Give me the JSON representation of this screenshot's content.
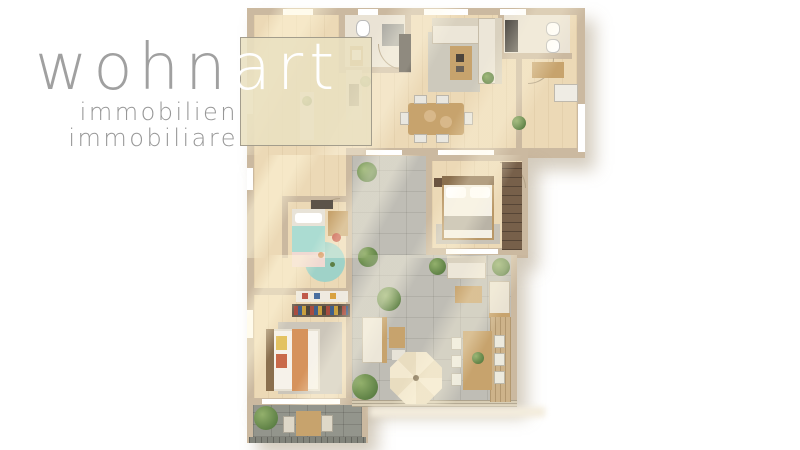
{
  "logo": {
    "brand_main": "wohn",
    "brand_accent": "art",
    "subtitle_de": "immobilien",
    "subtitle_it": "immobiliare"
  },
  "colors": {
    "wall": "#cbb9a0",
    "white": "#ffffff",
    "cream": "#ece6d8",
    "creamDark": "#d9d1bf",
    "woodF": "#c7a36d",
    "woodDark": "#8a6f4e",
    "darkUnit": "#54504a",
    "mint": "#abdcd2",
    "terracotta": "#d6935c",
    "grayRug": "#ccc6ba",
    "accentBeige": "#e9e0c0",
    "logoGray": "#a0a0a0"
  },
  "scene": [
    {
      "n": "footprint-top",
      "x": 247,
      "y": 8,
      "w": 338,
      "h": 150,
      "c": "wall",
      "cls": "shadow"
    },
    {
      "n": "footprint-mid",
      "x": 247,
      "y": 155,
      "w": 281,
      "h": 103,
      "c": "wall",
      "cls": "shadow"
    },
    {
      "n": "footprint-bottom",
      "x": 247,
      "y": 255,
      "w": 270,
      "h": 150,
      "c": "wall",
      "cls": "shadow"
    },
    {
      "n": "footprint-balcony",
      "x": 247,
      "y": 398,
      "w": 121,
      "h": 45,
      "c": "wall",
      "cls": "shadow"
    },
    {
      "n": "floor-living-dining",
      "x": 254,
      "y": 15,
      "w": 323,
      "h": 133,
      "cls": "wood"
    },
    {
      "n": "floor-hall-kids-room",
      "x": 254,
      "y": 148,
      "w": 92,
      "h": 146,
      "cls": "wood"
    },
    {
      "n": "floor-bedroom-2",
      "x": 254,
      "y": 294,
      "w": 92,
      "h": 105,
      "cls": "wood"
    },
    {
      "n": "floor-master-bedroom",
      "x": 432,
      "y": 161,
      "w": 90,
      "h": 89,
      "cls": "wood"
    },
    {
      "n": "terrace-upper",
      "x": 352,
      "y": 155,
      "w": 80,
      "h": 100,
      "cls": "tile"
    },
    {
      "n": "terrace-main",
      "x": 352,
      "y": 255,
      "w": 159,
      "h": 147,
      "cls": "tile"
    },
    {
      "n": "balcony-floor",
      "x": 253,
      "y": 404,
      "w": 109,
      "h": 33,
      "cls": "tiledark"
    },
    {
      "n": "bath1-floor",
      "x": 345,
      "y": 15,
      "w": 60,
      "h": 52,
      "cls": "lightfloor"
    },
    {
      "n": "bath2-floor",
      "x": 504,
      "y": 15,
      "w": 66,
      "h": 38,
      "cls": "lightfloor"
    },
    {
      "n": "wall-living-terrace-divider",
      "x": 346,
      "y": 148,
      "w": 182,
      "h": 8,
      "c": "wall"
    },
    {
      "n": "wall-kids-right",
      "x": 346,
      "y": 156,
      "w": 6,
      "h": 138,
      "c": "wall"
    },
    {
      "n": "wall-bedroom2-top",
      "x": 254,
      "y": 288,
      "w": 92,
      "h": 7,
      "c": "wall"
    },
    {
      "n": "wall-master-left",
      "x": 426,
      "y": 155,
      "w": 6,
      "h": 100,
      "c": "wall"
    },
    {
      "n": "wall-master-bottom",
      "x": 426,
      "y": 248,
      "w": 102,
      "h": 7,
      "c": "wall"
    },
    {
      "n": "wall-terrace-right",
      "x": 511,
      "y": 255,
      "w": 6,
      "h": 150,
      "c": "wall"
    },
    {
      "n": "wall-balcony-right",
      "x": 362,
      "y": 398,
      "w": 6,
      "h": 45,
      "c": "wall"
    },
    {
      "n": "wall-bedroom2-bottom",
      "x": 247,
      "y": 398,
      "w": 115,
      "h": 7,
      "c": "wall"
    },
    {
      "n": "wall-kids-top",
      "x": 282,
      "y": 196,
      "w": 70,
      "h": 6,
      "c": "wall"
    },
    {
      "n": "wall-kids-left",
      "x": 282,
      "y": 196,
      "w": 6,
      "h": 62,
      "c": "wall"
    },
    {
      "n": "wall-bath1-left",
      "x": 339,
      "y": 15,
      "w": 6,
      "h": 58,
      "c": "wall"
    },
    {
      "n": "wall-bath1-bottom",
      "x": 345,
      "y": 67,
      "w": 66,
      "h": 6,
      "c": "wall"
    },
    {
      "n": "wall-bath1-right",
      "x": 405,
      "y": 15,
      "w": 6,
      "h": 58,
      "c": "wall"
    },
    {
      "n": "wall-bath2-left",
      "x": 498,
      "y": 15,
      "w": 6,
      "h": 44,
      "c": "wall"
    },
    {
      "n": "wall-bath2-bottom",
      "x": 498,
      "y": 53,
      "w": 74,
      "h": 6,
      "c": "wall"
    },
    {
      "n": "wall-hall-divider",
      "x": 516,
      "y": 59,
      "w": 6,
      "h": 96,
      "c": "wall"
    },
    {
      "n": "window-top-1",
      "x": 283,
      "y": 9,
      "w": 30,
      "h": 6,
      "c": "white"
    },
    {
      "n": "window-top-2",
      "x": 358,
      "y": 9,
      "w": 20,
      "h": 6,
      "c": "white"
    },
    {
      "n": "window-top-3",
      "x": 424,
      "y": 9,
      "w": 44,
      "h": 6,
      "c": "white"
    },
    {
      "n": "window-top-4",
      "x": 500,
      "y": 9,
      "w": 26,
      "h": 6,
      "c": "white"
    },
    {
      "n": "window-left-1",
      "x": 247,
      "y": 88,
      "w": 6,
      "h": 26,
      "c": "white"
    },
    {
      "n": "window-left-2",
      "x": 247,
      "y": 168,
      "w": 6,
      "h": 22,
      "c": "white"
    },
    {
      "n": "window-left-3",
      "x": 247,
      "y": 310,
      "w": 6,
      "h": 28,
      "c": "white"
    },
    {
      "n": "window-right-1",
      "x": 578,
      "y": 104,
      "w": 7,
      "h": 48,
      "c": "white"
    },
    {
      "n": "window-slider-1",
      "x": 366,
      "y": 150,
      "w": 36,
      "h": 5,
      "c": "white"
    },
    {
      "n": "window-slider-2",
      "x": 438,
      "y": 150,
      "w": 56,
      "h": 5,
      "c": "white"
    },
    {
      "n": "window-master",
      "x": 446,
      "y": 249,
      "w": 52,
      "h": 5,
      "c": "white"
    },
    {
      "n": "window-bedroom2",
      "x": 262,
      "y": 399,
      "w": 78,
      "h": 5,
      "c": "white"
    },
    {
      "n": "terrace-railing",
      "x": 352,
      "y": 400,
      "w": 165,
      "h": 7,
      "cls": "rail"
    },
    {
      "n": "balcony-railing",
      "x": 249,
      "y": 437,
      "w": 117,
      "h": 6,
      "cls": "raildark"
    },
    {
      "n": "terrace-shadow-band",
      "x": 370,
      "y": 407,
      "w": 175,
      "h": 10,
      "c": "#f3ecdc",
      "cls": "soft"
    },
    {
      "n": "door-arc-bath1",
      "x": 378,
      "y": 44,
      "w": 26,
      "h": 26,
      "cls": "arc-bl"
    },
    {
      "n": "door-arc-hall",
      "x": 528,
      "y": 58,
      "w": 26,
      "h": 26,
      "cls": "arc-br"
    },
    {
      "n": "door-arc-master",
      "x": 500,
      "y": 162,
      "w": 26,
      "h": 26,
      "cls": "arc-tr"
    },
    {
      "n": "door-arc-kids",
      "x": 318,
      "y": 198,
      "w": 22,
      "h": 22,
      "cls": "arc-tl"
    },
    {
      "n": "living-rug",
      "x": 428,
      "y": 32,
      "w": 52,
      "h": 60,
      "c": "#cdc9bc"
    },
    {
      "n": "sofa-horizontal",
      "x": 432,
      "y": 18,
      "w": 70,
      "h": 26,
      "c": "cream",
      "b": "1px solid rgba(130,110,80,0.35)"
    },
    {
      "n": "sofa-back-top",
      "x": 432,
      "y": 18,
      "w": 70,
      "h": 8,
      "c": "creamDark"
    },
    {
      "n": "sofa-vertical",
      "x": 478,
      "y": 18,
      "w": 24,
      "h": 66,
      "c": "cream",
      "b": "1px solid rgba(130,110,80,0.35)"
    },
    {
      "n": "sofa-back-right",
      "x": 495,
      "y": 18,
      "w": 7,
      "h": 66,
      "c": "creamDark"
    },
    {
      "n": "coffee-table",
      "x": 450,
      "y": 46,
      "w": 22,
      "h": 34,
      "c": "woodF"
    },
    {
      "n": "coffee-table-decor-1",
      "x": 456,
      "y": 54,
      "w": 8,
      "h": 8,
      "c": "#4c443c"
    },
    {
      "n": "coffee-table-decor-2",
      "x": 456,
      "y": 66,
      "w": 8,
      "h": 6,
      "c": "#6b6258"
    },
    {
      "n": "dining-table",
      "x": 408,
      "y": 103,
      "w": 56,
      "h": 32,
      "c": "woodF",
      "r": "3px"
    },
    {
      "n": "dining-chair-1",
      "x": 414,
      "y": 95,
      "w": 13,
      "h": 9,
      "c": "#e9e7e0",
      "b": "1px solid rgba(120,110,90,0.4)"
    },
    {
      "n": "dining-chair-2",
      "x": 436,
      "y": 95,
      "w": 13,
      "h": 9,
      "c": "#e9e7e0",
      "b": "1px solid rgba(120,110,90,0.4)"
    },
    {
      "n": "dining-chair-3",
      "x": 414,
      "y": 134,
      "w": 13,
      "h": 9,
      "c": "#e9e7e0",
      "b": "1px solid rgba(120,110,90,0.4)"
    },
    {
      "n": "dining-chair-4",
      "x": 436,
      "y": 134,
      "w": 13,
      "h": 9,
      "c": "#e9e7e0",
      "b": "1px solid rgba(120,110,90,0.4)"
    },
    {
      "n": "dining-chair-5",
      "x": 400,
      "y": 112,
      "w": 9,
      "h": 13,
      "c": "#e9e7e0",
      "b": "1px solid rgba(120,110,90,0.4)"
    },
    {
      "n": "dining-chair-6",
      "x": 464,
      "y": 112,
      "w": 9,
      "h": 13,
      "c": "#e9e7e0",
      "b": "1px solid rgba(120,110,90,0.4)"
    },
    {
      "n": "dining-stool-1",
      "x": 424,
      "y": 110,
      "d": 12,
      "c": "#d8b88a"
    },
    {
      "n": "dining-stool-2",
      "x": 440,
      "y": 116,
      "d": 12,
      "c": "#d8b88a"
    },
    {
      "n": "kitchen-counter",
      "x": 346,
      "y": 70,
      "w": 16,
      "h": 50,
      "c": "#e9e1d1"
    },
    {
      "n": "kitchen-cooktop",
      "x": 349,
      "y": 84,
      "w": 10,
      "h": 22,
      "c": "#4a453f"
    },
    {
      "n": "kitchen-island",
      "x": 300,
      "y": 92,
      "w": 14,
      "h": 48,
      "c": "#f1eee7"
    },
    {
      "n": "island-plant",
      "x": 302,
      "y": 96,
      "d": 10,
      "cls": "plant"
    },
    {
      "n": "counter-plant",
      "x": 360,
      "y": 76,
      "d": 11,
      "cls": "plant"
    },
    {
      "n": "toilet-bath1",
      "x": 356,
      "y": 20,
      "w": 14,
      "h": 17,
      "c": "white",
      "r": "40%",
      "b": "1px solid #bbb"
    },
    {
      "n": "shower-tray",
      "x": 382,
      "y": 24,
      "w": 22,
      "h": 22,
      "c": "#a9a8a2"
    },
    {
      "n": "shower-glass-panel",
      "x": 399,
      "y": 34,
      "w": 12,
      "h": 38,
      "c": "#45403a"
    },
    {
      "n": "vanity-bath1",
      "x": 350,
      "y": 46,
      "w": 13,
      "h": 20,
      "c": "woodF"
    },
    {
      "n": "basin-bath1",
      "x": 352,
      "y": 50,
      "w": 9,
      "h": 10,
      "c": "white"
    },
    {
      "n": "washer-stack",
      "x": 505,
      "y": 20,
      "w": 13,
      "h": 32,
      "c": "darkUnit"
    },
    {
      "n": "toilet-bath2",
      "x": 546,
      "y": 22,
      "w": 14,
      "h": 14,
      "c": "white",
      "r": "40%",
      "b": "1px solid #bbb"
    },
    {
      "n": "bidet-bath2",
      "x": 546,
      "y": 39,
      "w": 14,
      "h": 14,
      "c": "white",
      "r": "40%",
      "b": "1px solid #bbb"
    },
    {
      "n": "hall-bench",
      "x": 532,
      "y": 62,
      "w": 32,
      "h": 16,
      "c": "woodF"
    },
    {
      "n": "hall-wardrobe",
      "x": 554,
      "y": 84,
      "w": 24,
      "h": 18,
      "c": "#efece4",
      "b": "1px solid rgba(120,110,90,0.4)"
    },
    {
      "n": "hall-plant",
      "x": 512,
      "y": 116,
      "d": 14,
      "cls": "plant"
    },
    {
      "n": "master-rug",
      "x": 436,
      "y": 224,
      "w": 64,
      "h": 20,
      "c": "#c9c3b7"
    },
    {
      "n": "master-bed-frame",
      "x": 442,
      "y": 176,
      "w": 52,
      "h": 64,
      "c": "#b99767"
    },
    {
      "n": "master-mattress",
      "x": 444,
      "y": 184,
      "w": 48,
      "h": 54,
      "c": "#f4f0e6"
    },
    {
      "n": "master-headboard",
      "x": 442,
      "y": 176,
      "w": 52,
      "h": 9,
      "c": "woodDark"
    },
    {
      "n": "master-pillow-1",
      "x": 446,
      "y": 187,
      "w": 20,
      "h": 11,
      "c": "white",
      "r": "3px"
    },
    {
      "n": "master-pillow-2",
      "x": 470,
      "y": 187,
      "w": 20,
      "h": 11,
      "c": "white",
      "r": "3px"
    },
    {
      "n": "master-throw",
      "x": 444,
      "y": 216,
      "w": 48,
      "h": 14,
      "c": "#b9b3a6"
    },
    {
      "n": "master-nightstand",
      "x": 434,
      "y": 178,
      "w": 8,
      "h": 9,
      "c": "#6b5440"
    },
    {
      "n": "master-wardrobe",
      "x": 502,
      "y": 162,
      "w": 20,
      "h": 88,
      "c": "#77604a",
      "cls": "shelves"
    },
    {
      "n": "kids-dresser",
      "x": 311,
      "y": 200,
      "w": 22,
      "h": 9,
      "c": "#5c5349"
    },
    {
      "n": "kids-rug",
      "x": 305,
      "y": 242,
      "d": 40,
      "c": "#9fd2c8"
    },
    {
      "n": "kids-bed-frame",
      "x": 292,
      "y": 209,
      "w": 33,
      "h": 58,
      "c": "#e8e3d8"
    },
    {
      "n": "kids-pillow",
      "x": 295,
      "y": 213,
      "w": 27,
      "h": 10,
      "c": "white",
      "r": "3px"
    },
    {
      "n": "kids-blanket-mint",
      "x": 292,
      "y": 226,
      "w": 33,
      "h": 26,
      "c": "mint"
    },
    {
      "n": "kids-blanket-pink",
      "x": 292,
      "y": 252,
      "w": 33,
      "h": 15,
      "c": "#f0d9d2"
    },
    {
      "n": "kids-desk",
      "x": 328,
      "y": 211,
      "w": 20,
      "h": 25,
      "c": "woodF"
    },
    {
      "n": "kids-chair",
      "x": 332,
      "y": 233,
      "d": 9,
      "c": "#c44f3e"
    },
    {
      "n": "kids-toy-1",
      "x": 318,
      "y": 252,
      "d": 6,
      "c": "terracotta"
    },
    {
      "n": "kids-toy-2",
      "x": 330,
      "y": 262,
      "d": 5,
      "c": "#5d7f46"
    },
    {
      "n": "bedroom2-art-shelf",
      "x": 296,
      "y": 291,
      "w": 52,
      "h": 11,
      "c": "#efeae0"
    },
    {
      "n": "art-item-1",
      "x": 302,
      "y": 293,
      "w": 6,
      "h": 6,
      "c": "#c05a4a"
    },
    {
      "n": "art-item-2",
      "x": 314,
      "y": 293,
      "w": 6,
      "h": 6,
      "c": "#4a6fa0"
    },
    {
      "n": "art-item-3",
      "x": 330,
      "y": 293,
      "w": 6,
      "h": 6,
      "c": "#d9a23f"
    },
    {
      "n": "bedroom2-bookshelf",
      "x": 292,
      "y": 304,
      "w": 58,
      "h": 13,
      "c": "#6b5e50"
    },
    {
      "n": "bookshelf-books",
      "x": 294,
      "y": 306,
      "w": 54,
      "h": 9,
      "cls": "books"
    },
    {
      "n": "bedroom2-rug",
      "x": 278,
      "y": 322,
      "w": 64,
      "h": 72,
      "c": "grayRug"
    },
    {
      "n": "bedroom2-bed-frame",
      "x": 266,
      "y": 329,
      "w": 54,
      "h": 62,
      "c": "#e6e0d2"
    },
    {
      "n": "bedroom2-headboard",
      "x": 266,
      "y": 329,
      "w": 8,
      "h": 62,
      "c": "woodDark"
    },
    {
      "n": "bedroom2-mattress",
      "x": 274,
      "y": 331,
      "w": 44,
      "h": 58,
      "c": "#f6f2ea"
    },
    {
      "n": "bedroom2-pillow-yellow",
      "x": 276,
      "y": 336,
      "w": 11,
      "h": 14,
      "c": "#e3c261"
    },
    {
      "n": "bedroom2-pillow-orange",
      "x": 276,
      "y": 354,
      "w": 11,
      "h": 14,
      "c": "#c96a4a"
    },
    {
      "n": "bedroom2-runner",
      "x": 292,
      "y": 329,
      "w": 16,
      "h": 62,
      "c": "terracotta"
    },
    {
      "n": "terrace-armchair",
      "x": 362,
      "y": 317,
      "w": 24,
      "h": 46,
      "c": "cream",
      "b": "1px solid rgba(130,110,80,0.35)"
    },
    {
      "n": "terrace-armchair-frame",
      "x": 382,
      "y": 317,
      "w": 5,
      "h": 46,
      "c": "woodF"
    },
    {
      "n": "terrace-side-table",
      "x": 389,
      "y": 327,
      "w": 16,
      "h": 21,
      "c": "woodF"
    },
    {
      "n": "terrace-side-chair",
      "x": 392,
      "y": 350,
      "w": 13,
      "h": 10,
      "c": "#e7e3d8"
    },
    {
      "n": "terrace-plant-1",
      "x": 377,
      "y": 287,
      "d": 24,
      "cls": "plant"
    },
    {
      "n": "terrace-plant-2",
      "x": 357,
      "y": 162,
      "d": 20,
      "cls": "plant"
    },
    {
      "n": "terrace-plant-3",
      "x": 358,
      "y": 247,
      "d": 20,
      "cls": "plant"
    },
    {
      "n": "outdoor-sofa",
      "x": 447,
      "y": 256,
      "w": 39,
      "h": 23,
      "c": "cream",
      "b": "1px solid rgba(130,110,80,0.35)"
    },
    {
      "n": "outdoor-sofa-back",
      "x": 447,
      "y": 256,
      "w": 39,
      "h": 7,
      "c": "creamDark"
    },
    {
      "n": "outdoor-sofa-plant",
      "x": 429,
      "y": 258,
      "d": 17,
      "cls": "plant"
    },
    {
      "n": "outdoor-coffee-table",
      "x": 455,
      "y": 286,
      "w": 27,
      "h": 17,
      "c": "woodF"
    },
    {
      "n": "lounger",
      "x": 489,
      "y": 281,
      "w": 21,
      "h": 36,
      "c": "#e9e2d2",
      "b": "1px solid rgba(130,110,80,0.35)"
    },
    {
      "n": "lounger-frame",
      "x": 489,
      "y": 313,
      "w": 21,
      "h": 5,
      "c": "woodF"
    },
    {
      "n": "lounger-plant",
      "x": 492,
      "y": 258,
      "d": 18,
      "cls": "plant"
    },
    {
      "n": "deck-strip",
      "x": 490,
      "y": 317,
      "w": 21,
      "h": 85,
      "cls": "deck"
    },
    {
      "n": "outdoor-dining-table",
      "x": 463,
      "y": 331,
      "w": 29,
      "h": 59,
      "c": "woodF"
    },
    {
      "n": "outdoor-chair-1",
      "x": 451,
      "y": 337,
      "w": 11,
      "h": 13,
      "c": "#eceade",
      "b": "1px solid rgba(120,110,90,0.4)"
    },
    {
      "n": "outdoor-chair-2",
      "x": 451,
      "y": 355,
      "w": 11,
      "h": 13,
      "c": "#eceade",
      "b": "1px solid rgba(120,110,90,0.4)"
    },
    {
      "n": "outdoor-chair-3",
      "x": 451,
      "y": 373,
      "w": 11,
      "h": 13,
      "c": "#eceade",
      "b": "1px solid rgba(120,110,90,0.4)"
    },
    {
      "n": "outdoor-chair-4",
      "x": 494,
      "y": 335,
      "w": 11,
      "h": 13,
      "c": "#eceade",
      "b": "1px solid rgba(120,110,90,0.4)"
    },
    {
      "n": "outdoor-chair-5",
      "x": 494,
      "y": 353,
      "w": 11,
      "h": 13,
      "c": "#eceade",
      "b": "1px solid rgba(120,110,90,0.4)"
    },
    {
      "n": "outdoor-chair-6",
      "x": 494,
      "y": 371,
      "w": 11,
      "h": 13,
      "c": "#eceade",
      "b": "1px solid rgba(120,110,90,0.4)"
    },
    {
      "n": "table-plant",
      "x": 472,
      "y": 352,
      "d": 12,
      "cls": "plant"
    },
    {
      "n": "parasol",
      "x": 390,
      "y": 352,
      "w": 52,
      "h": 52,
      "cls": "octa"
    },
    {
      "n": "parasol-pole",
      "x": 413,
      "y": 375,
      "d": 6,
      "c": "#8a7a5e"
    },
    {
      "n": "palm-plant",
      "x": 352,
      "y": 374,
      "d": 26,
      "cls": "plant"
    },
    {
      "n": "living-plant",
      "x": 482,
      "y": 72,
      "d": 12,
      "cls": "plant"
    },
    {
      "n": "balcony-bush",
      "x": 254,
      "y": 406,
      "d": 24,
      "cls": "plant"
    },
    {
      "n": "balcony-table",
      "x": 296,
      "y": 411,
      "w": 25,
      "h": 25,
      "c": "woodF"
    },
    {
      "n": "balcony-chair-1",
      "x": 283,
      "y": 416,
      "w": 12,
      "h": 17,
      "c": "#ded8c8",
      "b": "1px solid rgba(100,95,80,0.4)"
    },
    {
      "n": "balcony-chair-2",
      "x": 321,
      "y": 415,
      "w": 12,
      "h": 17,
      "c": "#ded8c8",
      "b": "1px solid rgba(100,95,80,0.4)"
    },
    {
      "n": "sunlight-top",
      "x": 247,
      "y": 8,
      "w": 338,
      "h": 147,
      "cls": "sun"
    },
    {
      "n": "sunlight-mid",
      "x": 247,
      "y": 155,
      "w": 281,
      "h": 103,
      "cls": "sun"
    },
    {
      "n": "sunlight-bottom",
      "x": 247,
      "y": 255,
      "w": 270,
      "h": 150,
      "cls": "sun"
    }
  ]
}
